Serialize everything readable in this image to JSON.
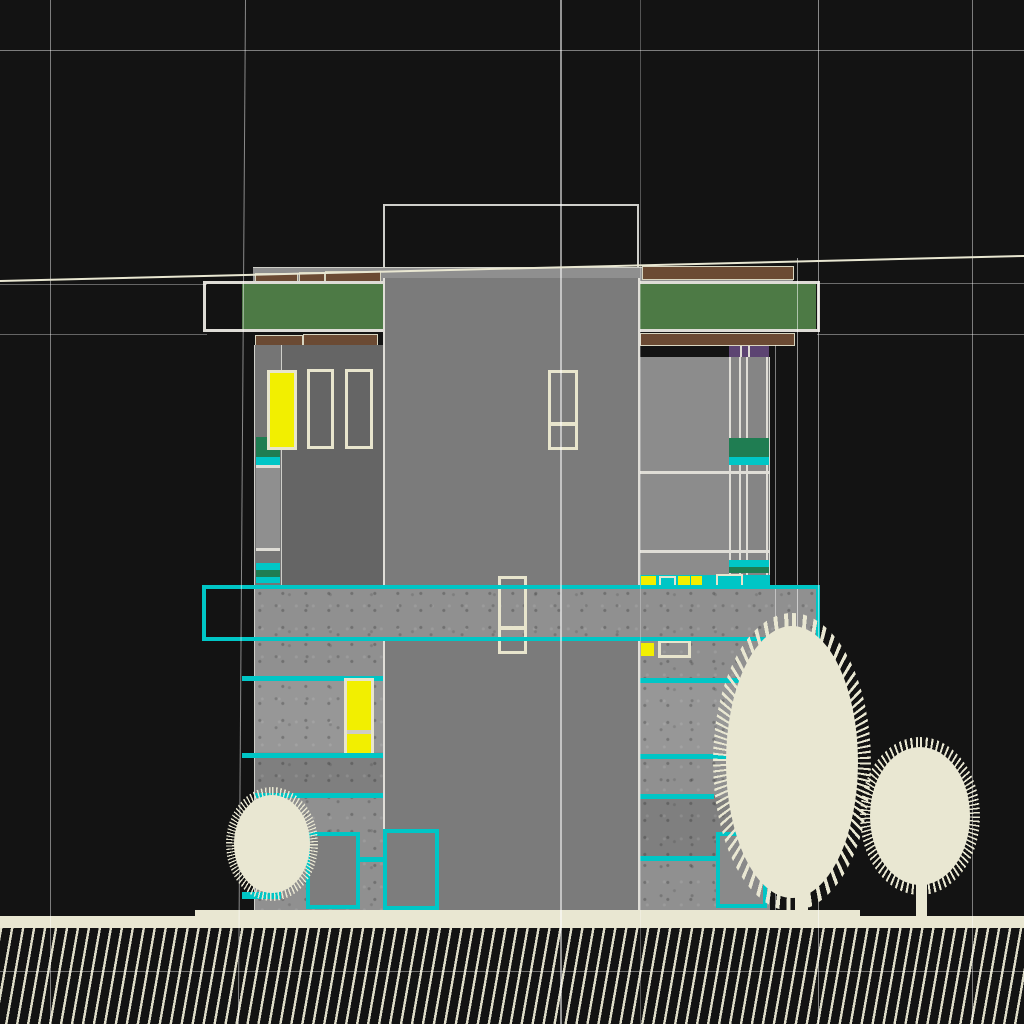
{
  "scene": {
    "view": "building-elevation-viewport",
    "tree_count": 3,
    "selection_highlight": "cyan",
    "lit_window_count": 2
  },
  "colors": {
    "background": "#131313",
    "guide_cream": "#e9e7d2",
    "outline_white": "#dedcd6",
    "frame_cream": "#e8e5cd",
    "selection_cyan": "#00c6c6",
    "window_yellow": "#f2ef00",
    "roof_green": "#4d7a45",
    "band_green": "#1f7d52",
    "fascia_brown": "#6b4a33",
    "accent_purple": "#5c4472",
    "wall_dark": "#656565",
    "wall_mid": "#7b7b7b",
    "wall_light": "#8c8c8c",
    "concrete": "#909090",
    "concrete_light": "#979797",
    "concrete_dark": "#7f7f7f",
    "tree_cream": "#e9e7d2",
    "ground_cream": "#e9e7d2"
  }
}
